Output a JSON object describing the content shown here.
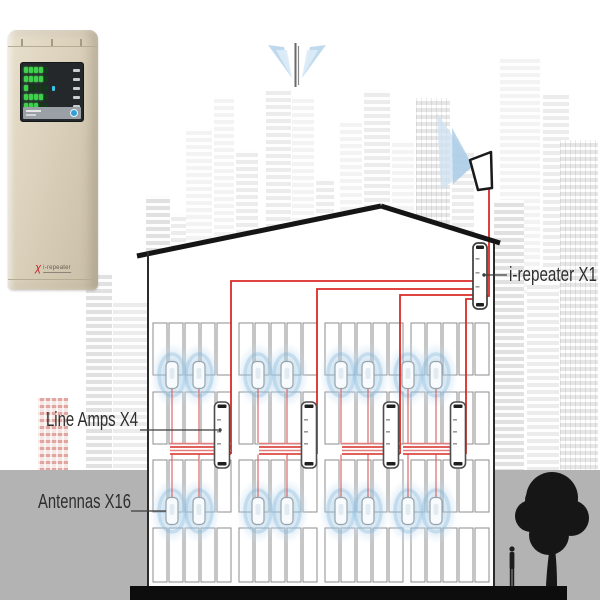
{
  "labels": {
    "repeater": "i-repeater X1",
    "line_amps": "Line Amps X4",
    "antennas": "Antennas X16"
  },
  "device_photo": {
    "logo_text": "i-repeater",
    "led_rows": [
      [
        1,
        1,
        1,
        1,
        0
      ],
      [
        1,
        1,
        1,
        1,
        0
      ],
      [
        1,
        0,
        0,
        0,
        0
      ],
      [
        1,
        1,
        1,
        1,
        0
      ],
      [
        1,
        1,
        1,
        0,
        0
      ]
    ],
    "cyan_row": 2
  },
  "colors": {
    "cable_red": "#d92b25",
    "cable_light_red": "#e87d7d",
    "drop_red": "#d95c5c",
    "halo_blue": "#7fb3d9",
    "led_green": "#3fd04b",
    "button_blue": "#2f9fd6",
    "ground_gray": "#b3b3b3",
    "roof_black": "#151515"
  },
  "diagram": {
    "antenna_xs": [
      172,
      199,
      258,
      287,
      341,
      368,
      408,
      436
    ],
    "antenna_row_ys": [
      375,
      511
    ],
    "amp_xs": [
      222,
      309,
      391,
      458
    ],
    "repeater": {
      "x": 480,
      "top": 243,
      "bottom": 309
    },
    "feeds": [
      {
        "x": 231,
        "y": 281
      },
      {
        "x": 317,
        "y": 289
      },
      {
        "x": 400,
        "y": 295
      },
      {
        "x": 466,
        "y": 299
      }
    ],
    "bundles": [
      [
        170,
        231
      ],
      [
        259,
        317
      ],
      [
        342,
        400
      ],
      [
        403,
        466
      ]
    ],
    "bundle_ys": [
      443.5,
      447,
      450.5,
      454
    ]
  }
}
